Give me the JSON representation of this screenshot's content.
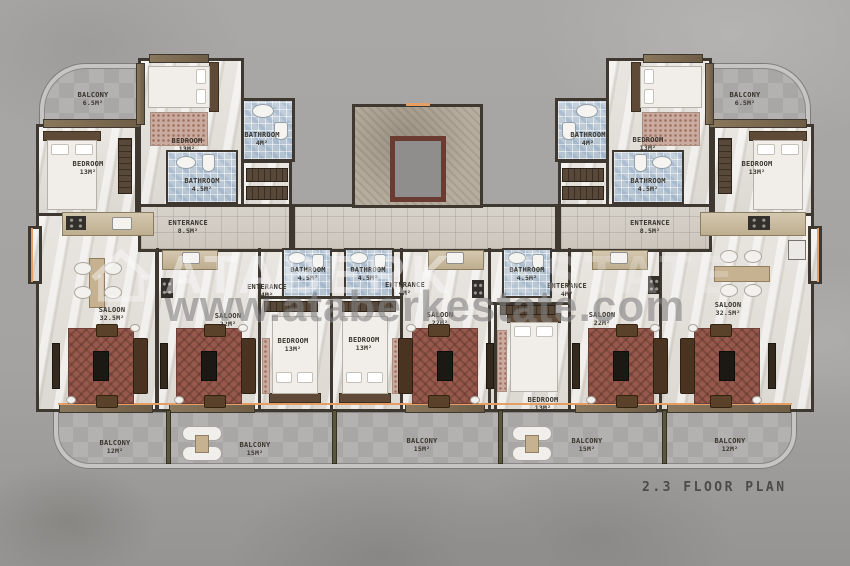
{
  "floor_plan": {
    "caption": "2.3 FLOOR PLAN",
    "watermark": {
      "brand_primary": "ATABERK",
      "brand_secondary": "ESTATE",
      "website": "www.ataberkestate.com",
      "logo_icon": "house-outline-icon"
    },
    "room_labels": [
      {
        "name": "BALCONY",
        "area": "6.5M²",
        "x": 93,
        "y": 99
      },
      {
        "name": "BEDROOM",
        "area": "13M²",
        "x": 88,
        "y": 168
      },
      {
        "name": "BEDROOM",
        "area": "13M²",
        "x": 187,
        "y": 145
      },
      {
        "name": "BATHROOM",
        "area": "4M²",
        "x": 262,
        "y": 139
      },
      {
        "name": "BATHROOM",
        "area": "4.5M²",
        "x": 202,
        "y": 185
      },
      {
        "name": "ENTERANCE",
        "area": "8.5M²",
        "x": 188,
        "y": 227
      },
      {
        "name": "SALOON",
        "area": "32.5M²",
        "x": 112,
        "y": 314
      },
      {
        "name": "SALOON",
        "area": "22M²",
        "x": 228,
        "y": 320
      },
      {
        "name": "BATHROOM",
        "area": "4.5M²",
        "x": 308,
        "y": 274
      },
      {
        "name": "ENTERANCE",
        "area": "4M²",
        "x": 267,
        "y": 291
      },
      {
        "name": "BEDROOM",
        "area": "13M²",
        "x": 293,
        "y": 345
      },
      {
        "name": "BATHROOM",
        "area": "4.5M²",
        "x": 368,
        "y": 274
      },
      {
        "name": "ENTERANCE",
        "area": "4M²",
        "x": 405,
        "y": 289
      },
      {
        "name": "BEDROOM",
        "area": "13M²",
        "x": 364,
        "y": 344
      },
      {
        "name": "SALOON",
        "area": "22M²",
        "x": 440,
        "y": 319
      },
      {
        "name": "BATHROOM",
        "area": "4.5M²",
        "x": 527,
        "y": 274
      },
      {
        "name": "ENTERANCE",
        "area": "4M²",
        "x": 567,
        "y": 290
      },
      {
        "name": "BEDROOM",
        "area": "13M²",
        "x": 543,
        "y": 404
      },
      {
        "name": "SALOON",
        "area": "22M²",
        "x": 602,
        "y": 319
      },
      {
        "name": "BATHROOM",
        "area": "4.5M²",
        "x": 648,
        "y": 185
      },
      {
        "name": "ENTERANCE",
        "area": "8.5M²",
        "x": 650,
        "y": 227
      },
      {
        "name": "BATHROOM",
        "area": "4M²",
        "x": 588,
        "y": 139
      },
      {
        "name": "BEDROOM",
        "area": "13M²",
        "x": 648,
        "y": 144
      },
      {
        "name": "BEDROOM",
        "area": "13M²",
        "x": 757,
        "y": 168
      },
      {
        "name": "BALCONY",
        "area": "6.5M²",
        "x": 745,
        "y": 99
      },
      {
        "name": "SALOON",
        "area": "32.5M²",
        "x": 728,
        "y": 309
      },
      {
        "name": "BALCONY",
        "area": "12M²",
        "x": 115,
        "y": 447
      },
      {
        "name": "BALCONY",
        "area": "15M²",
        "x": 255,
        "y": 449
      },
      {
        "name": "BALCONY",
        "area": "15M²",
        "x": 422,
        "y": 445
      },
      {
        "name": "BALCONY",
        "area": "15M²",
        "x": 587,
        "y": 445
      },
      {
        "name": "BALCONY",
        "area": "12M²",
        "x": 730,
        "y": 445
      }
    ],
    "colors": {
      "background": "#a7a5a3",
      "wall": "#3e3831",
      "wood_wall": "#7b6a52",
      "window_accent": "#e59f66",
      "marble_floor": "#e6e3de",
      "bathroom_tile": "#bccad7",
      "balcony_tile": "#adabaa",
      "carpet": "#96594c",
      "sofa": "#4a3421",
      "caption_text": "#4b4b49"
    }
  }
}
